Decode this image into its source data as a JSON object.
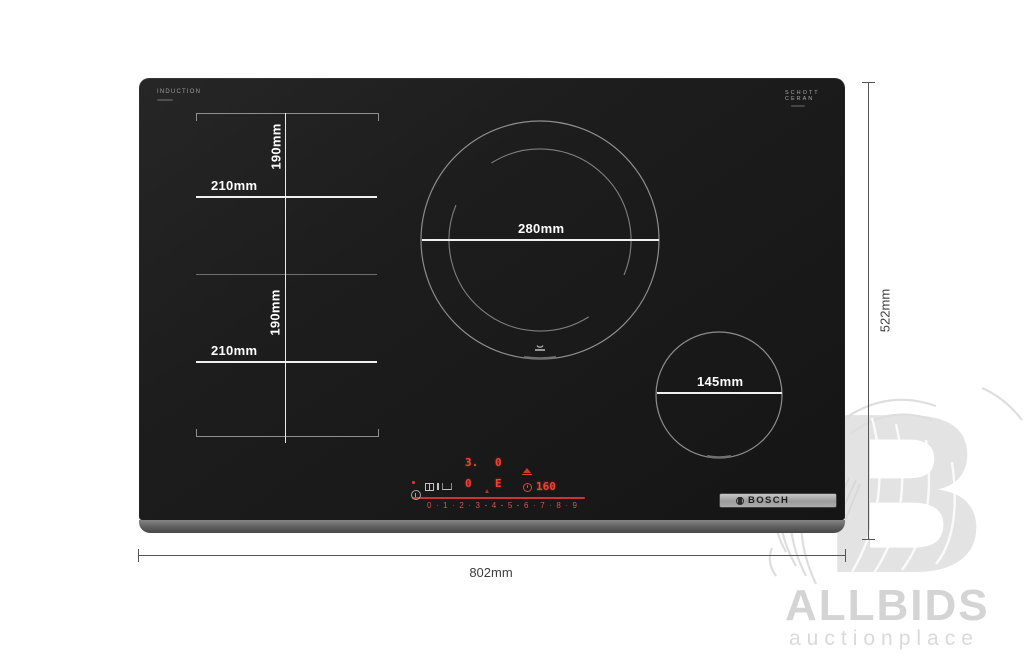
{
  "cooktop": {
    "branding": {
      "surface_type": "INDUCTION",
      "glass_brand_line1": "SCHOTT",
      "glass_brand_line2": "CERAN",
      "logo": "BOSCH"
    },
    "zones": {
      "flex_top": {
        "width": "210mm",
        "height": "190mm"
      },
      "flex_bottom": {
        "width": "210mm",
        "height": "190mm"
      },
      "burner_large": "280mm",
      "burner_small": "145mm"
    },
    "panel": {
      "display_top_left": "3.",
      "display_top_right": "0",
      "display_bottom_left": "0",
      "display_bottom_right": "E",
      "timer": "160",
      "slider": [
        "0",
        "1",
        "2",
        "3",
        "4",
        "5",
        "6",
        "7",
        "8",
        "9"
      ]
    }
  },
  "dimensions": {
    "width": "802mm",
    "height": "522mm"
  },
  "watermark": {
    "letter": "B",
    "brand": "ALLBIDS",
    "tagline": "auctionplace"
  }
}
